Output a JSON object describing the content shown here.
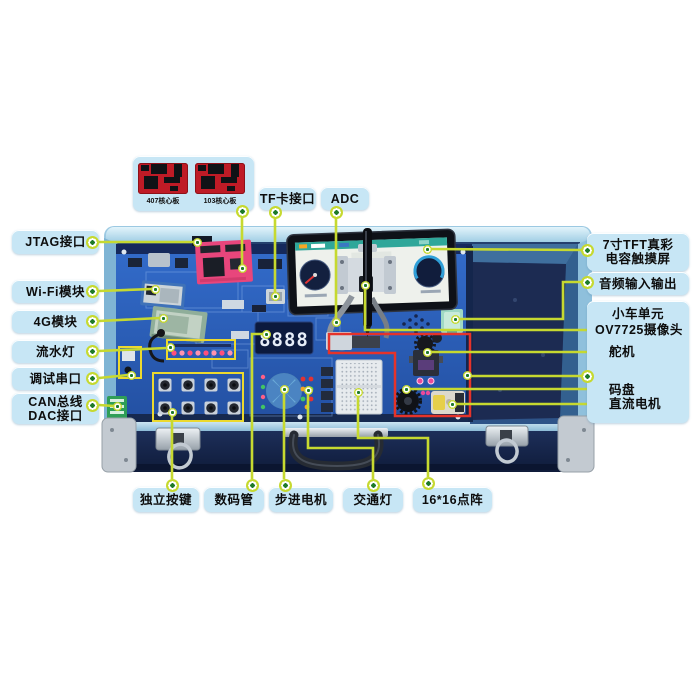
{
  "colors": {
    "callout_bg": "#c7e6f5",
    "leader_line": "#c6d930",
    "dot_center_green": "#1e7a28",
    "car_unit_outline_red": "#e5332a",
    "board_zone_outline_yellow": "#ecd92e",
    "board_blue": "#2a5cb8",
    "case_trim_cyan": "#a8d8ee",
    "foam_navy": "#1c2b52",
    "core_pcb_red": "#bf1b26",
    "screen_topbar_teal": "#2fa79a"
  },
  "callouts": {
    "left": [
      {
        "label": "JTAG接口"
      },
      {
        "label": "Wi-Fi模块"
      },
      {
        "label": "4G模块"
      },
      {
        "label": "流水灯"
      },
      {
        "label": "调试串口"
      },
      {
        "label": "CAN总线",
        "label2": "DAC接口"
      }
    ],
    "top": {
      "core_captions": [
        "407核心板",
        "103核心板"
      ],
      "tf": "TF卡接口",
      "adc": "ADC"
    },
    "right": {
      "tft_line1": "7寸TFT真彩",
      "tft_line2": "电容触摸屏",
      "audio": "音频输入输出",
      "car_title": "小车单元",
      "camera": "OV7725摄像头",
      "servo": "舵机",
      "encoder": "码盘",
      "dc_motor": "直流电机"
    },
    "bottom": [
      {
        "label": "独立按键"
      },
      {
        "label": "数码管"
      },
      {
        "label": "步进电机"
      },
      {
        "label": "交通灯"
      },
      {
        "label": "16*16点阵"
      }
    ]
  },
  "board": {
    "seven_seg_digits": "8888"
  }
}
